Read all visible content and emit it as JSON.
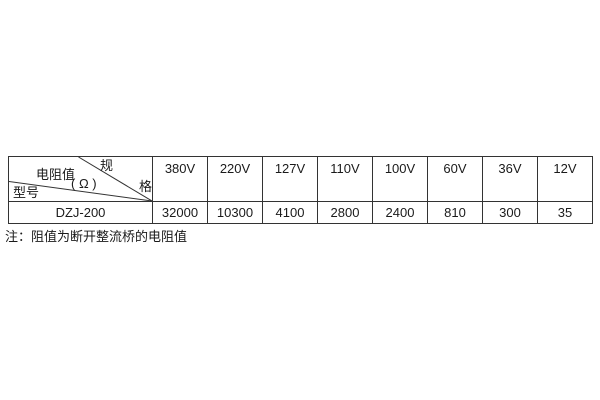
{
  "table": {
    "corner": {
      "spec_char_top": "规",
      "spec_char_bottom": "格",
      "resistance_label": "电阻值",
      "resistance_unit": "( Ω )",
      "model_label": "型号"
    },
    "columns": [
      "380V",
      "220V",
      "127V",
      "110V",
      "100V",
      "60V",
      "36V",
      "12V"
    ],
    "row": {
      "model": "DZJ-200",
      "values": [
        "32000",
        "10300",
        "4100",
        "2800",
        "2400",
        "810",
        "300",
        "35"
      ]
    }
  },
  "note": "注：阻值为断开整流桥的电阻值",
  "colors": {
    "background": "#ffffff",
    "border": "#333333",
    "text": "#1a1a1a"
  }
}
